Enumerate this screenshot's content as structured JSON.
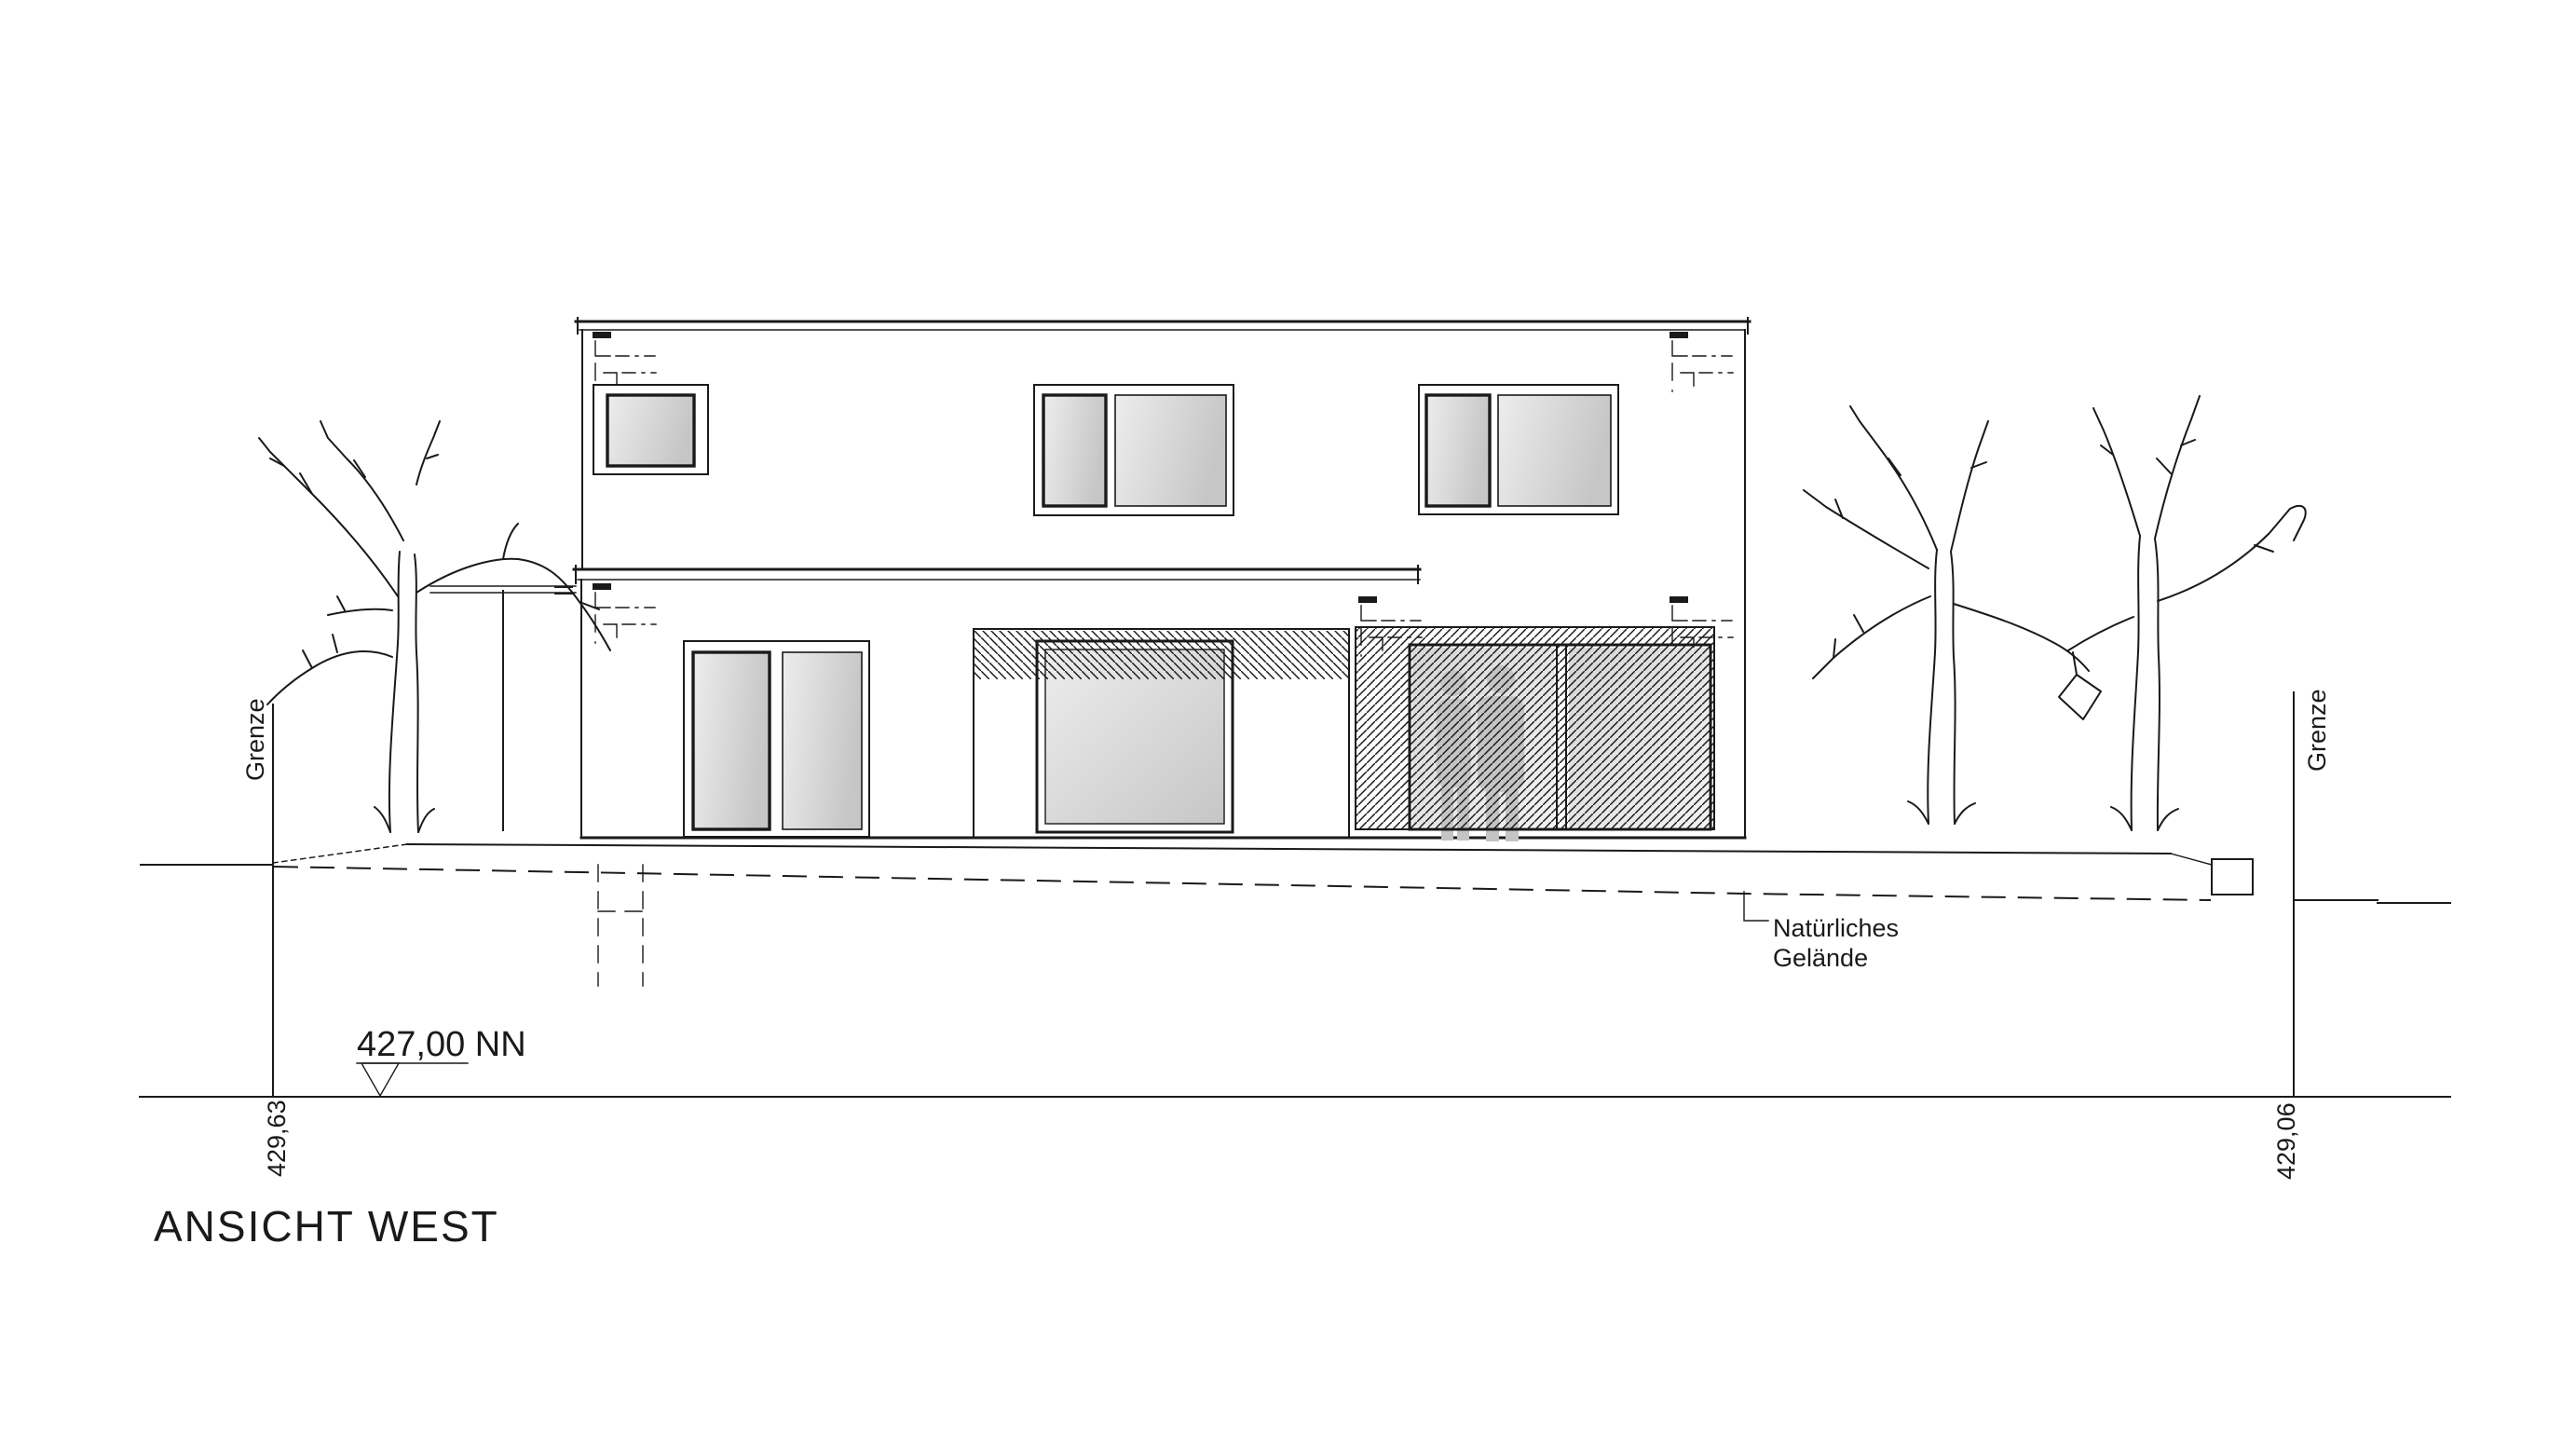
{
  "drawing": {
    "title": "ANSICHT WEST",
    "datum": {
      "label": "427,00 NN"
    },
    "boundaries": {
      "left": {
        "label": "Grenze",
        "elevation": "429,63"
      },
      "right": {
        "label": "Grenze",
        "elevation": "429,06"
      }
    },
    "terrain": {
      "label_line1": "Natürliches",
      "label_line2": "Gelände"
    },
    "colors": {
      "line": "#1a1a1a",
      "background": "#ffffff",
      "glazing_light": "#ededed",
      "glazing_dark": "#c6c6c6",
      "door_glazing_light": "#f2f2f2",
      "door_glazing_dark": "#d6d6d6",
      "silhouette": "#c4c4c4"
    }
  }
}
